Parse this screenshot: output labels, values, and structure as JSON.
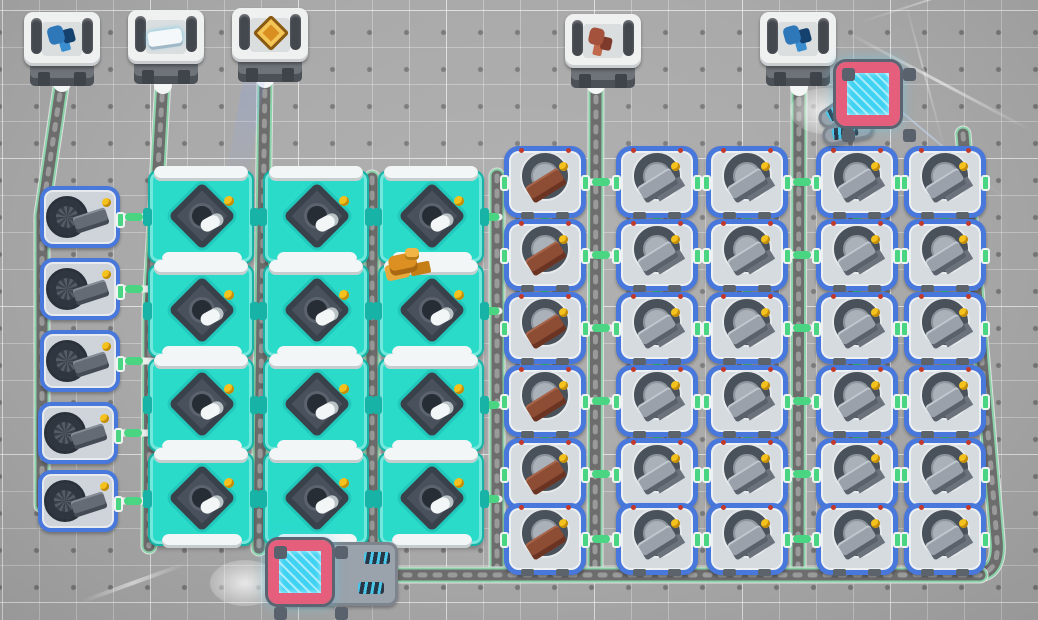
{
  "scene": {
    "width": 1038,
    "height": 620,
    "colors": {
      "bg": "#a9a9a9",
      "grid_line": "#c4c4c4",
      "grid_dot": "#8b8b8b",
      "belt_edge": "#e6e6e6",
      "belt_glow": "#43c97c",
      "belt_core": "#6d6d6d",
      "belt_chevron": "#9f9f9f",
      "link_light": "#eceeee",
      "link_green": "#49d581",
      "assembler_body": "#2adbca",
      "machine_border": "#4878dc",
      "cube_frame": "#e55f7d",
      "cube_glow": "#3fd2f2",
      "indicator_yellow": "#f5c11d",
      "item_brown": "#8d4c34",
      "item_gray": "#9aa1aa",
      "item_white": "#f4f8fa",
      "item_blue_crystal": "#2e77b8",
      "item_red_gem": "#a5523c",
      "item_orange": "#dc9022"
    }
  },
  "containers": [
    {
      "x": 24,
      "y": 12,
      "item": "blue-crystals",
      "label": "storage-blue-crystals-1"
    },
    {
      "x": 128,
      "y": 10,
      "item": "white-plate",
      "label": "storage-white-plates"
    },
    {
      "x": 232,
      "y": 8,
      "item": "circuit",
      "label": "storage-circuits"
    },
    {
      "x": 565,
      "y": 14,
      "item": "red-gems",
      "label": "storage-red-gems"
    },
    {
      "x": 760,
      "y": 12,
      "item": "blue-crystals",
      "label": "storage-blue-crystals-2"
    }
  ],
  "assemblers": [
    {
      "x": 148,
      "y": 170
    },
    {
      "x": 263,
      "y": 170
    },
    {
      "x": 378,
      "y": 170
    },
    {
      "x": 148,
      "y": 264
    },
    {
      "x": 263,
      "y": 264
    },
    {
      "x": 378,
      "y": 264
    },
    {
      "x": 148,
      "y": 358
    },
    {
      "x": 263,
      "y": 358
    },
    {
      "x": 378,
      "y": 358
    },
    {
      "x": 148,
      "y": 452
    },
    {
      "x": 263,
      "y": 452
    },
    {
      "x": 378,
      "y": 452
    }
  ],
  "crafters": {
    "col_x": [
      504,
      616,
      706,
      816,
      904
    ],
    "row_y": [
      146,
      219,
      292,
      365,
      438,
      503
    ],
    "col_items": [
      "brown",
      "gray",
      "gray",
      "gray",
      "gray"
    ]
  },
  "miners": [
    {
      "x": 40,
      "y": 186
    },
    {
      "x": 40,
      "y": 258
    },
    {
      "x": 40,
      "y": 330
    },
    {
      "x": 38,
      "y": 402
    },
    {
      "x": 38,
      "y": 470
    }
  ],
  "energy_cubes": [
    {
      "variant": "top-right",
      "x": 820,
      "y": 60
    },
    {
      "variant": "bottom",
      "x": 252,
      "y": 538
    }
  ],
  "belts": [
    {
      "path": "M62,80 L42,215 L42,505"
    },
    {
      "path": "M163,80 L150,310 L149,546"
    },
    {
      "path": "M265,76 L259,548"
    },
    {
      "path": "M372,178 L372,574"
    },
    {
      "path": "M497,176 L497,574"
    },
    {
      "path": "M596,82 L595,574"
    },
    {
      "path": "M799,84 L798,574"
    },
    {
      "path": "M963,134 L997,540 Q1000,574 976,574"
    },
    {
      "path": "M980,575 L316,575"
    }
  ],
  "belt_caps": [
    {
      "x": 53,
      "y": 66
    },
    {
      "x": 154,
      "y": 68
    },
    {
      "x": 256,
      "y": 62
    },
    {
      "x": 587,
      "y": 68
    },
    {
      "x": 790,
      "y": 70
    }
  ],
  "links": {
    "horizontal": [
      {
        "x1": 116,
        "x2": 152,
        "y": 217
      },
      {
        "x1": 116,
        "x2": 152,
        "y": 289
      },
      {
        "x1": 116,
        "x2": 152,
        "y": 361
      },
      {
        "x1": 114,
        "x2": 152,
        "y": 433
      },
      {
        "x1": 114,
        "x2": 152,
        "y": 501
      },
      {
        "x1": 252,
        "x2": 267,
        "y": 217
      },
      {
        "x1": 367,
        "x2": 382,
        "y": 217
      },
      {
        "x1": 482,
        "x2": 499,
        "y": 217
      },
      {
        "x1": 252,
        "x2": 267,
        "y": 311
      },
      {
        "x1": 367,
        "x2": 382,
        "y": 311
      },
      {
        "x1": 482,
        "x2": 499,
        "y": 311
      },
      {
        "x1": 252,
        "x2": 267,
        "y": 405
      },
      {
        "x1": 367,
        "x2": 382,
        "y": 405
      },
      {
        "x1": 482,
        "x2": 499,
        "y": 405
      },
      {
        "x1": 252,
        "x2": 267,
        "y": 499
      },
      {
        "x1": 367,
        "x2": 382,
        "y": 499
      },
      {
        "x1": 482,
        "x2": 499,
        "y": 499
      },
      {
        "x1": 584,
        "x2": 618,
        "y": 182
      },
      {
        "x1": 696,
        "x2": 710,
        "y": 182
      },
      {
        "x1": 786,
        "x2": 818,
        "y": 182
      },
      {
        "x1": 896,
        "x2": 908,
        "y": 182
      },
      {
        "x1": 584,
        "x2": 618,
        "y": 255
      },
      {
        "x1": 696,
        "x2": 710,
        "y": 255
      },
      {
        "x1": 786,
        "x2": 818,
        "y": 255
      },
      {
        "x1": 896,
        "x2": 908,
        "y": 255
      },
      {
        "x1": 584,
        "x2": 618,
        "y": 328
      },
      {
        "x1": 696,
        "x2": 710,
        "y": 328
      },
      {
        "x1": 786,
        "x2": 818,
        "y": 328
      },
      {
        "x1": 896,
        "x2": 908,
        "y": 328
      },
      {
        "x1": 584,
        "x2": 618,
        "y": 401
      },
      {
        "x1": 696,
        "x2": 710,
        "y": 401
      },
      {
        "x1": 786,
        "x2": 818,
        "y": 401
      },
      {
        "x1": 896,
        "x2": 908,
        "y": 401
      },
      {
        "x1": 584,
        "x2": 618,
        "y": 474
      },
      {
        "x1": 696,
        "x2": 710,
        "y": 474
      },
      {
        "x1": 786,
        "x2": 818,
        "y": 474
      },
      {
        "x1": 896,
        "x2": 908,
        "y": 474
      },
      {
        "x1": 584,
        "x2": 618,
        "y": 539
      },
      {
        "x1": 696,
        "x2": 710,
        "y": 539
      },
      {
        "x1": 786,
        "x2": 818,
        "y": 539
      },
      {
        "x1": 896,
        "x2": 908,
        "y": 539
      }
    ],
    "vertical": [
      {
        "x": 545,
        "y1": 212,
        "y2": 224
      },
      {
        "x": 657,
        "y1": 212,
        "y2": 224
      },
      {
        "x": 747,
        "y1": 212,
        "y2": 224
      },
      {
        "x": 857,
        "y1": 212,
        "y2": 224
      },
      {
        "x": 945,
        "y1": 212,
        "y2": 224
      },
      {
        "x": 545,
        "y1": 285,
        "y2": 297
      },
      {
        "x": 657,
        "y1": 285,
        "y2": 297
      },
      {
        "x": 747,
        "y1": 285,
        "y2": 297
      },
      {
        "x": 857,
        "y1": 285,
        "y2": 297
      },
      {
        "x": 945,
        "y1": 285,
        "y2": 297
      },
      {
        "x": 545,
        "y1": 358,
        "y2": 370
      },
      {
        "x": 657,
        "y1": 358,
        "y2": 370
      },
      {
        "x": 747,
        "y1": 358,
        "y2": 370
      },
      {
        "x": 857,
        "y1": 358,
        "y2": 370
      },
      {
        "x": 945,
        "y1": 358,
        "y2": 370
      },
      {
        "x": 545,
        "y1": 431,
        "y2": 443
      },
      {
        "x": 657,
        "y1": 431,
        "y2": 443
      },
      {
        "x": 747,
        "y1": 431,
        "y2": 443
      },
      {
        "x": 857,
        "y1": 431,
        "y2": 443
      },
      {
        "x": 945,
        "y1": 431,
        "y2": 443
      },
      {
        "x": 545,
        "y1": 498,
        "y2": 508
      },
      {
        "x": 657,
        "y1": 498,
        "y2": 508
      },
      {
        "x": 747,
        "y1": 498,
        "y2": 508
      },
      {
        "x": 857,
        "y1": 498,
        "y2": 508
      },
      {
        "x": 945,
        "y1": 498,
        "y2": 508
      }
    ]
  },
  "decor": {
    "orange_bot": {
      "x": 381,
      "y": 248
    },
    "beams": [
      {
        "x": 268,
        "y": -10,
        "len": 200,
        "angle": 100,
        "w": 22,
        "color": "rgba(130,160,255,0.18)"
      },
      {
        "x": 845,
        "y": 30,
        "len": 210,
        "angle": 28,
        "w": 3,
        "color": "rgba(255,255,255,0.55)"
      },
      {
        "x": 835,
        "y": 55,
        "len": 230,
        "angle": 40,
        "w": 2,
        "color": "rgba(200,225,255,0.5)"
      },
      {
        "x": 858,
        "y": 22,
        "len": 160,
        "angle": -18,
        "w": 2,
        "color": "rgba(255,255,255,0.4)"
      },
      {
        "x": 905,
        "y": 0,
        "len": 150,
        "angle": 75,
        "w": 2,
        "color": "rgba(255,255,255,0.35)"
      },
      {
        "x": 185,
        "y": 562,
        "len": 110,
        "angle": 160,
        "w": 4,
        "color": "rgba(255,255,255,0.5)"
      }
    ],
    "glow_spots": [
      {
        "x": 210,
        "y": 560
      },
      {
        "x": 790,
        "y": 88
      }
    ]
  }
}
